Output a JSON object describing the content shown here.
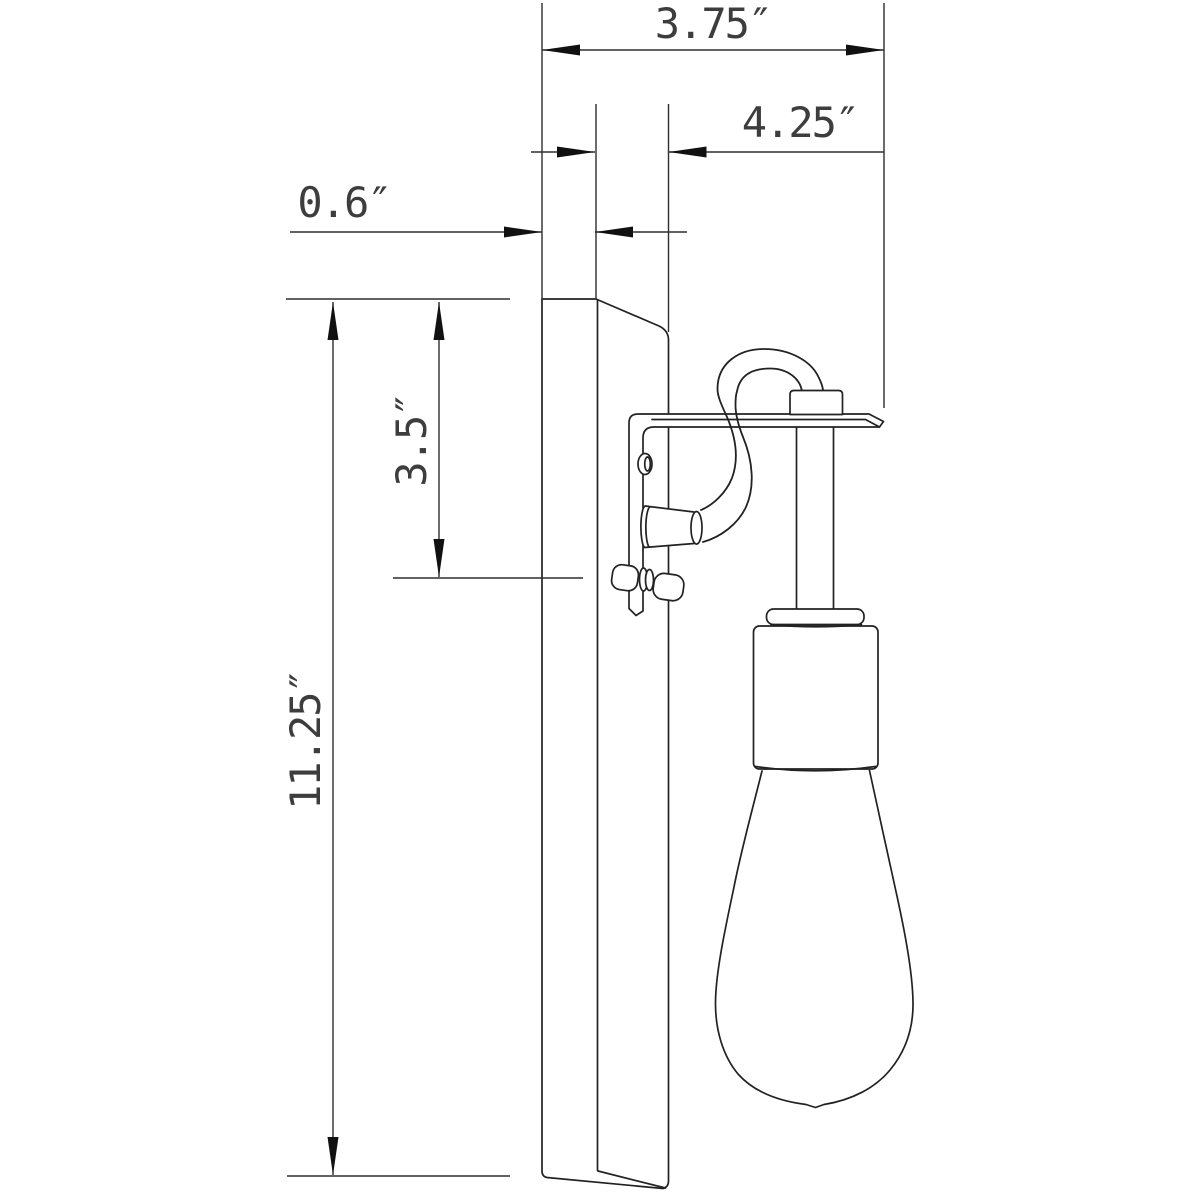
{
  "colors": {
    "background": "#ffffff",
    "line": "#222222",
    "dimension_line": "#2e2e2e",
    "arrow": "#111111",
    "label_text": "#3d3d3d"
  },
  "dimensions": {
    "total_depth": {
      "label": "3.75″",
      "value": 3.75,
      "unit": "in"
    },
    "projection": {
      "label": "4.25″",
      "value": 4.25,
      "unit": "in"
    },
    "backplate_thickness": {
      "label": "0.6″",
      "value": 0.6,
      "unit": "in"
    },
    "top_to_bracket": {
      "label": "3.5″",
      "value": 3.5,
      "unit": "in"
    },
    "backplate_height": {
      "label": "11.25″",
      "value": 11.25,
      "unit": "in"
    }
  },
  "components": {
    "backplate": "wall-backplate",
    "bracket": "l-mounting-bracket",
    "cord": "looped-power-cord",
    "cord_connector": "cord-ferrule",
    "cord_grip": "cord-grip-block",
    "stem": "socket-stem",
    "flange": "socket-flange",
    "socket": "lamp-socket",
    "bulb": "edison-bulb",
    "screws": "mounting-screws"
  }
}
